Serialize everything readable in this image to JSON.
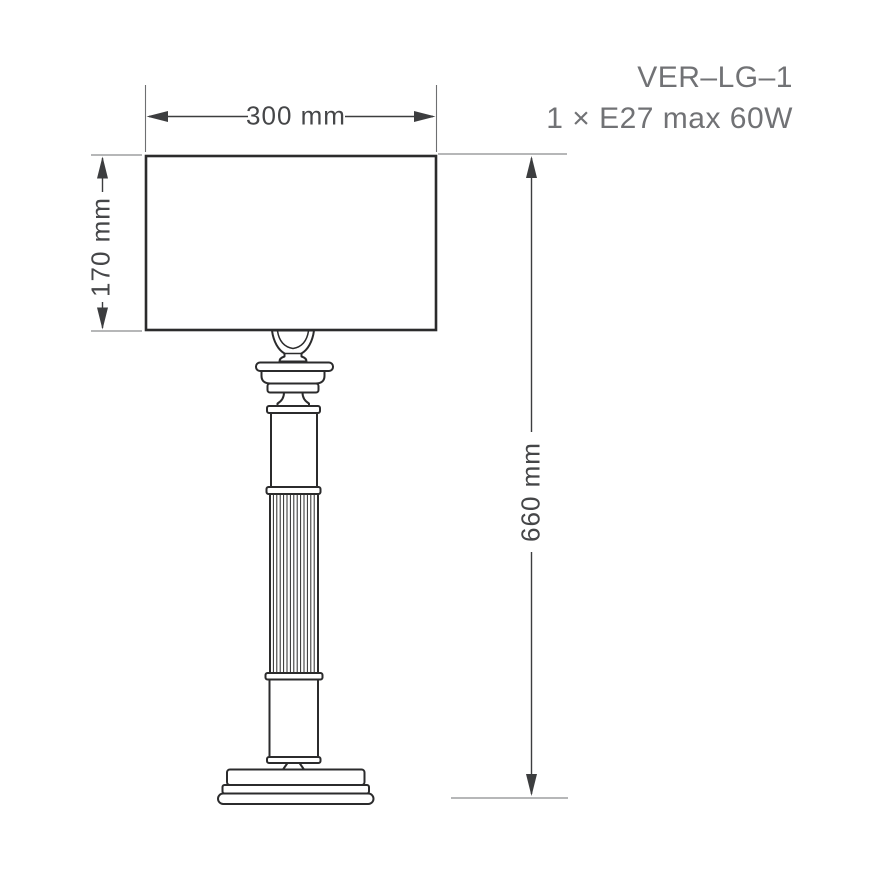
{
  "product": {
    "code": "VER–LG–1",
    "spec": "1 × E27 max 60W"
  },
  "dimensions": {
    "shade_width": "300 mm",
    "shade_height": "170 mm",
    "total_height": "660 mm"
  },
  "colors": {
    "line": "#2b2b2c",
    "dim": "#3c3d3f",
    "ext": "#6e6f71",
    "dim-text": "#454648",
    "title-text": "#717275",
    "background": "#ffffff"
  }
}
